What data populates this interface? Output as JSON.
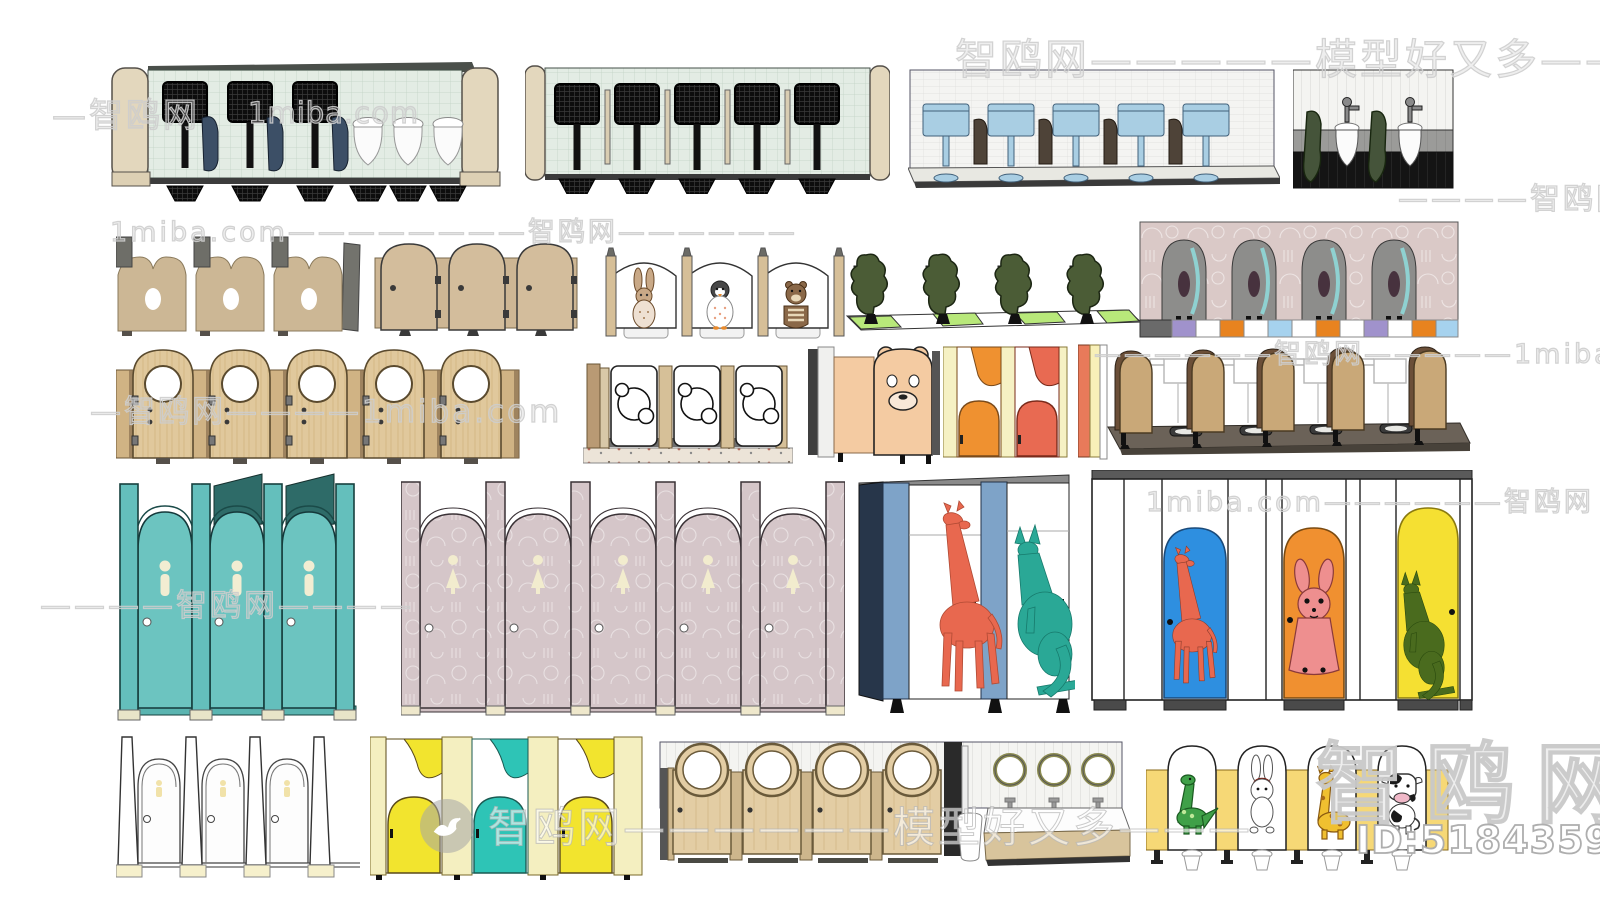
{
  "watermarks": {
    "top": "智鸥网—————模型好又多————",
    "top_left": "—智鸥网",
    "top_left_site": "1miba.com",
    "row2": "1miba.com————————智鸥网——————",
    "right_edge": "————智鸥网—",
    "row3_left": "—智鸥网————1miba.com",
    "row3_right": "——————智鸥网—————1miba.com",
    "row4_left": "————智鸥网————",
    "row4_right": "1miba.com——————智鸥网",
    "bottom_center": "智鸥网——————模型好又多———",
    "bottom_right_brand": "智鸥网",
    "model_id": "ID:518435969"
  },
  "models": [
    "urinal-wall-mint-sensor",
    "urinal-wall-mint-five",
    "cistern-wall-blue",
    "urinal-wall-tri-band",
    "partition-tan-notched",
    "partition-tan-arched-doors",
    "partition-white-animal-arcs",
    "partition-green-trees",
    "urinal-wall-pink-arches",
    "doors-wood-porthole",
    "partition-koala-cutout",
    "partition-bear-face",
    "partition-orange-coral-wave",
    "squat-row-wood-arches",
    "partition-teal-arch-doors",
    "partition-mauve-arch-doors",
    "partition-giraffe-kangaroo",
    "partition-color-doors-animals",
    "partition-white-outline",
    "partition-yellow-teal-wave",
    "stalls-porthole-with-sinks",
    "partition-cartoon-animals"
  ]
}
